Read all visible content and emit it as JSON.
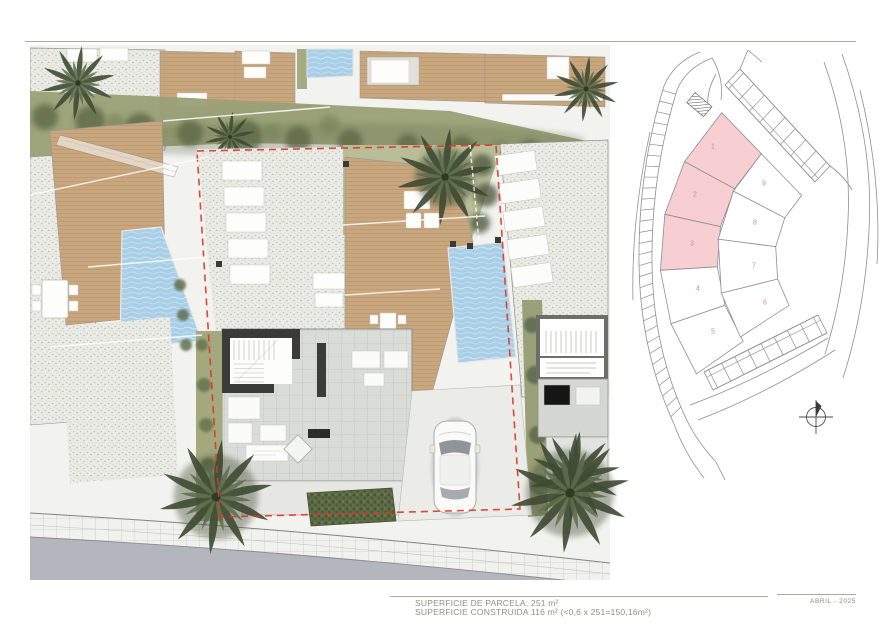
{
  "footer": {
    "line1": "SUPERFICIE DE PARCELA: 251 m²",
    "line2": "SUPERFICIE CONSTRUIDA 116 m² (<0,6 x 251=150,16m²)",
    "date": "ABRIL - 2025"
  },
  "key_plan": {
    "highlight_color": "#f7cfd3",
    "number_color": "#d8888c",
    "outline_color": "#8f8f8f",
    "plots": [
      {
        "label": "1",
        "highlighted": true,
        "points": "93.7,64.7 133.3,105.7 106.6,140.8 56.5,113.6",
        "lx": 85,
        "ly": 98
      },
      {
        "label": "2",
        "highlighted": true,
        "points": "56.5,113.6 106.6,140.8 92.4,178.6 36.8,166.3",
        "lx": 67,
        "ly": 146
      },
      {
        "label": "3",
        "highlighted": true,
        "points": "36.8,166.3 92.4,178.6 89.3,218.8 32.4,222.3",
        "lx": 64,
        "ly": 195
      },
      {
        "label": "4",
        "highlighted": false,
        "points": "32.4,222.3 89.3,218.8 96.9,257.2 43,275.8",
        "lx": 70,
        "ly": 240
      },
      {
        "label": "5",
        "highlighted": false,
        "points": "43,275.8 96.9,257.2 115.2,293.2 68.5,325.9",
        "lx": 85,
        "ly": 283
      },
      {
        "label": "6",
        "highlighted": false,
        "points": "93.3,245.1 149.6,231 161,257.4 112.4,289",
        "lx": 137,
        "ly": 254
      },
      {
        "label": "7",
        "highlighted": false,
        "points": "90.2,191.1 147.7,198.6 149.6,231 93.3,245.1",
        "lx": 126,
        "ly": 217
      },
      {
        "label": "8",
        "highlighted": false,
        "points": "105.4,143.1 156.8,169.8 147.7,198.6 90.2,191.1",
        "lx": 127,
        "ly": 174
      },
      {
        "label": "9",
        "highlighted": false,
        "points": "133.3,105.7 173.6,147.4 156.8,169.8 105.4,143.1",
        "lx": 136,
        "ly": 135
      }
    ]
  },
  "main_plan_colors": {
    "pool": "#a9cfe7",
    "deck": "#c8a67e",
    "plot_boundary_red": "#e23322",
    "vegetation": "#5c6845",
    "roof": "#dadcd7",
    "road": "#b4b6be"
  }
}
